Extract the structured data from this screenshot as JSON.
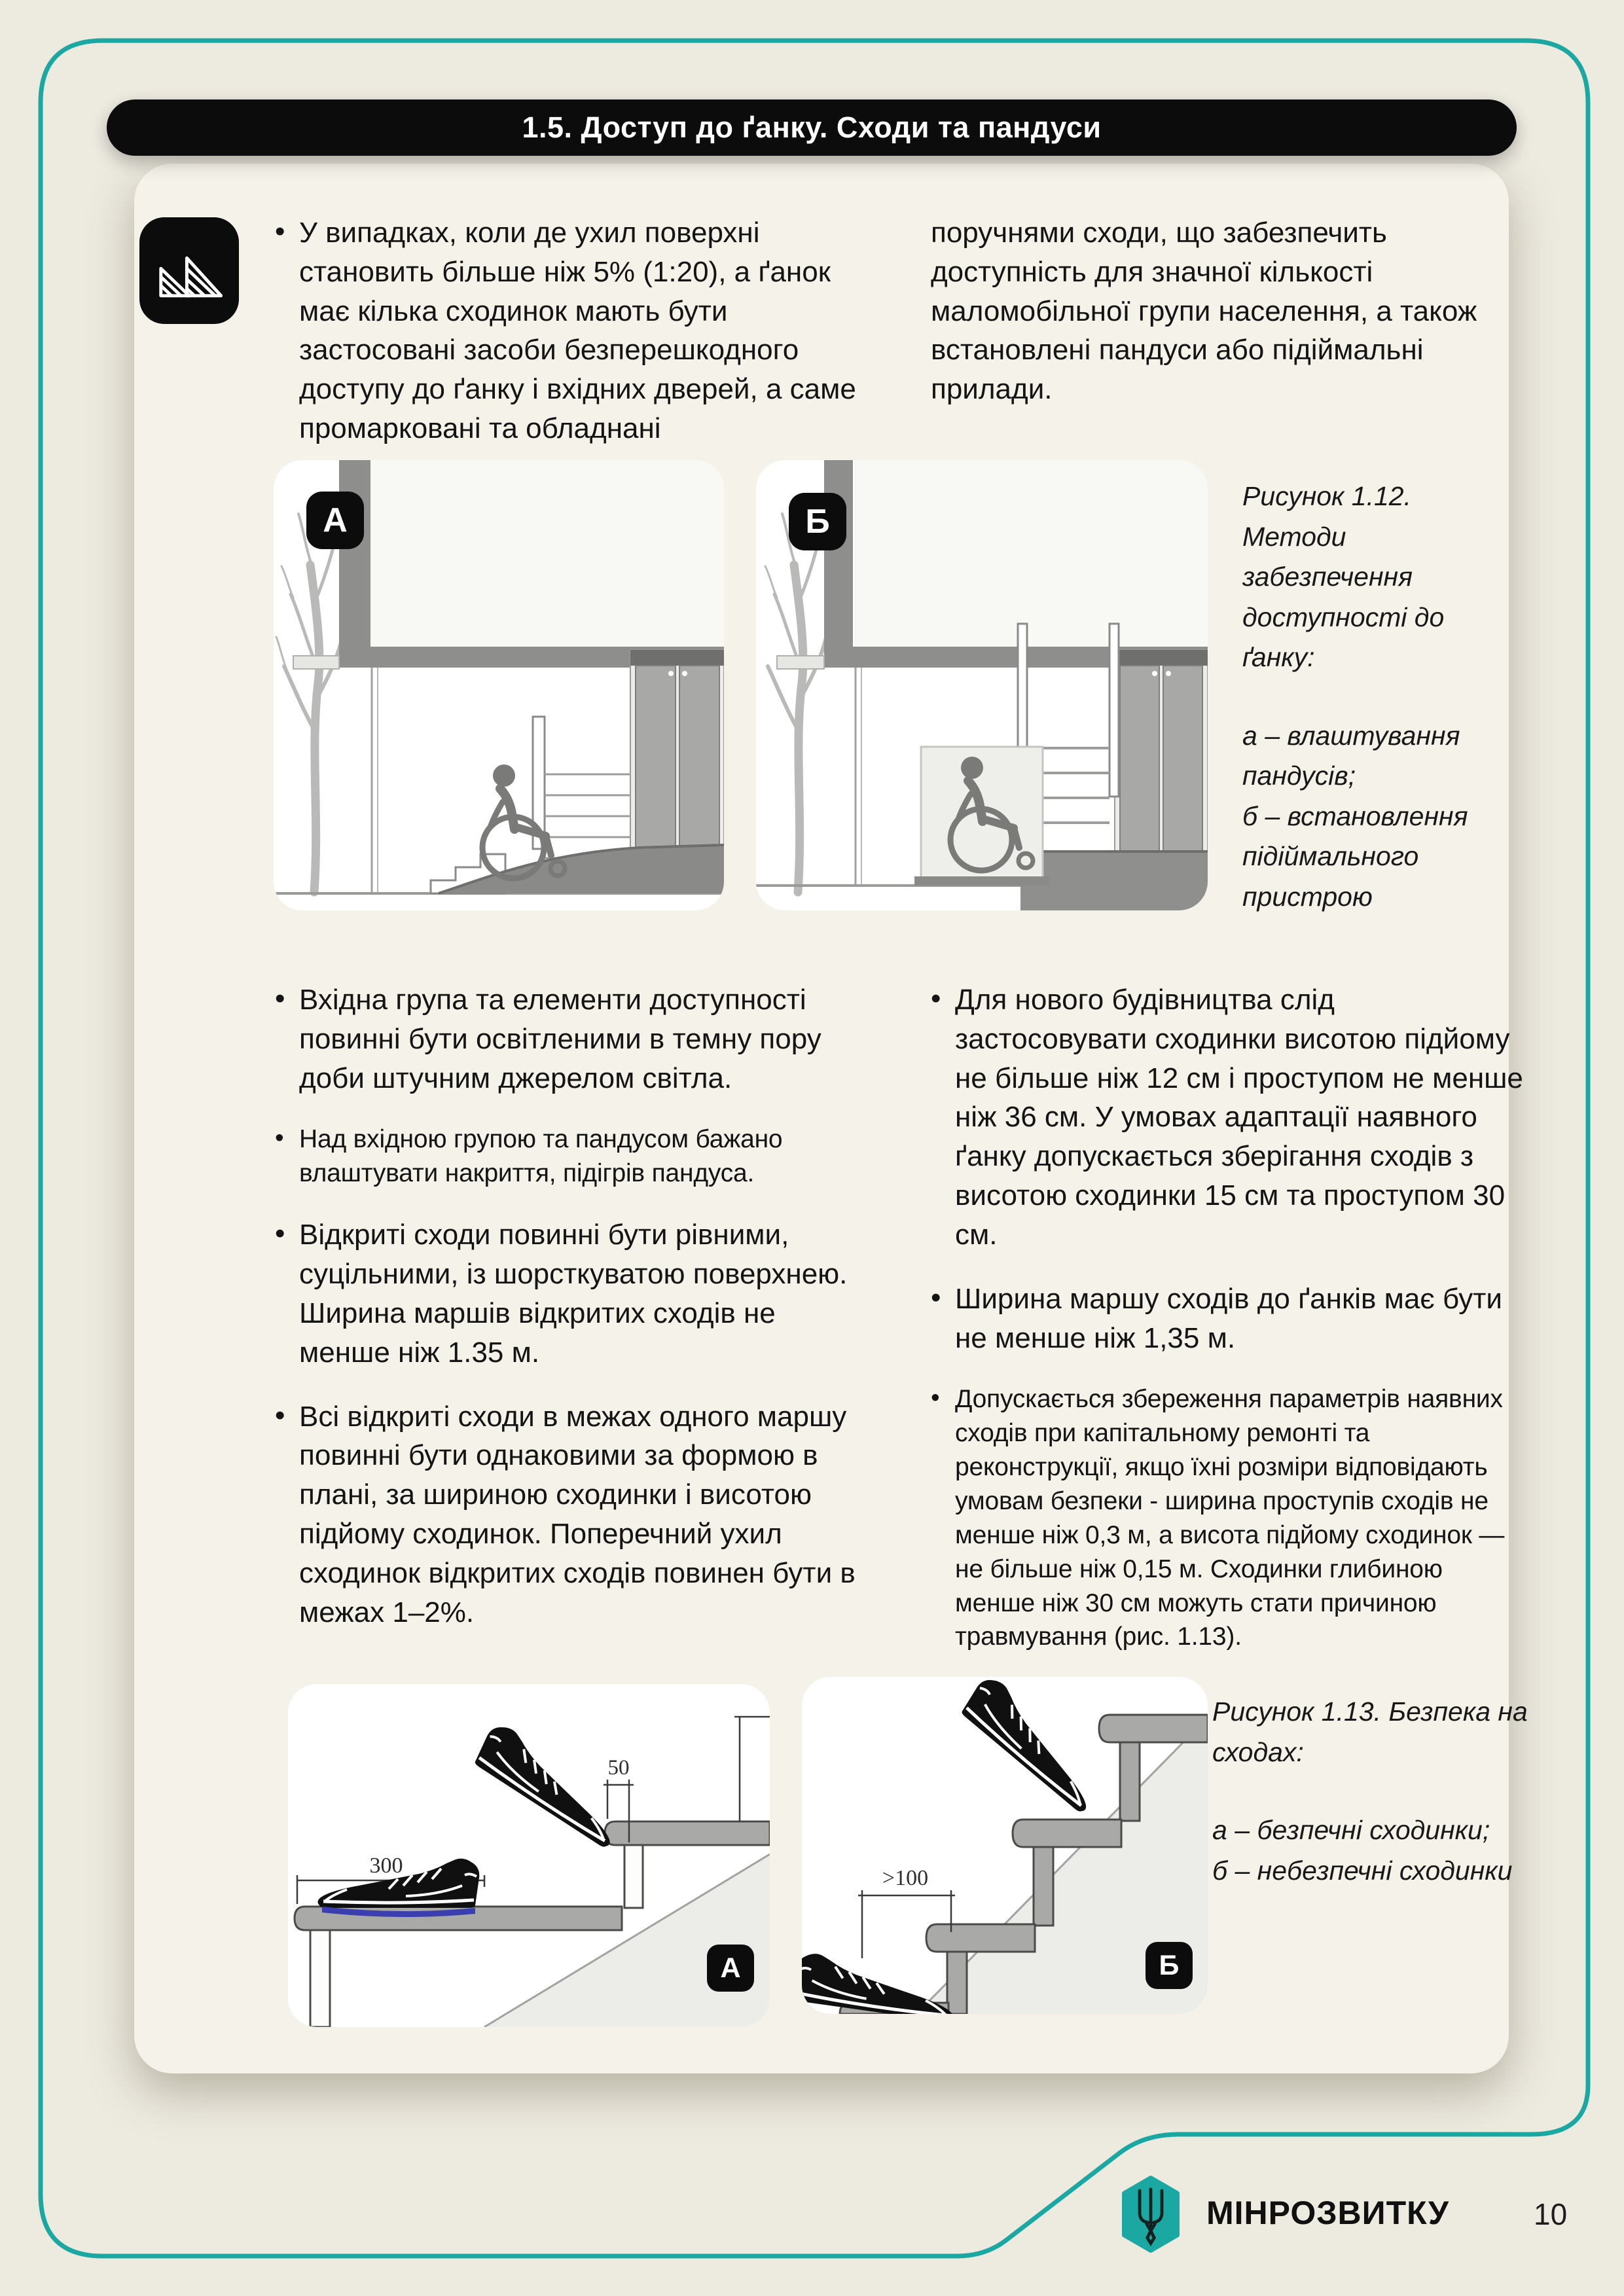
{
  "header": {
    "title": "1.5. Доступ до ґанку. Сходи та пандуси"
  },
  "intro": {
    "left": "У випадках, коли де ухил поверхні становить більше ніж 5% (1:20), а ґанок має кілька сходинок мають бути застосовані засоби безперешкодного доступу до ґанку і вхідних дверей, а саме промарковані та обладнані",
    "right": "поручнями сходи, що забезпечить доступність для значної кількості маломобільної групи населення, а також встановлені пандуси або підіймальні прилади."
  },
  "fig112": {
    "label_a": "А",
    "label_b": "Б",
    "caption": "Рисунок 1.12. Методи забезпечення доступності до ґанку:",
    "item_a": "а – влаштування пандусів;",
    "item_b": "б – встановлення підіймального пристрою"
  },
  "bullets_left": [
    "Вхідна група та елементи доступності повинні бути освітленими в темну пору доби штучним джерелом світла.",
    "Над вхідною групою та пандусом бажано влаштувати накриття, підігрів пандуса.",
    "Відкриті сходи повинні бути рівними, суцільними, із шорсткуватою поверхнею. Ширина маршів відкритих сходів не менше ніж 1.35 м.",
    "Всі відкриті сходи в межах одного маршу повинні бути однаковими за формою в плані, за шириною сходинки і висотою підйому сходинок. Поперечний ухил сходинок відкритих сходів повинен бути в межах 1–2%."
  ],
  "bullets_right": [
    "Для нового будівництва слід застосовувати сходинки висотою підйому не більше ніж 12 см і проступом не менше ніж 36 см. У умовах адаптації наявного ґанку допускається зберігання сходів з висотою сходинки 15 см та проступом 30 см.",
    "Ширина маршу сходів до ґанків має бути не менше ніж 1,35 м.",
    "Допускається збереження параметрів наявних сходів при капітальному ремонті та реконструкції, якщо їхні розміри відповідають умовам безпеки - ширина проступів сходів не менше ніж 0,3 м, а висота підйому сходинок — не більше ніж 0,15 м. Сходинки глибиною менше ніж 30 см можуть стати причиною травмування (рис. 1.13)."
  ],
  "fig113": {
    "label_a": "А",
    "label_b": "Б",
    "caption": "Рисунок 1.13. Безпека на сходах:",
    "item_a": "а – безпечні сходинки;",
    "item_b": "б – небезпечні сходинки",
    "dim_300": "300",
    "dim_50": "50",
    "dim_100": ">100"
  },
  "footer": {
    "org": "МІНРОЗВИТКУ",
    "page": "10"
  },
  "colors": {
    "accent": "#1BA8A3",
    "ink": "#0C0C0C"
  }
}
